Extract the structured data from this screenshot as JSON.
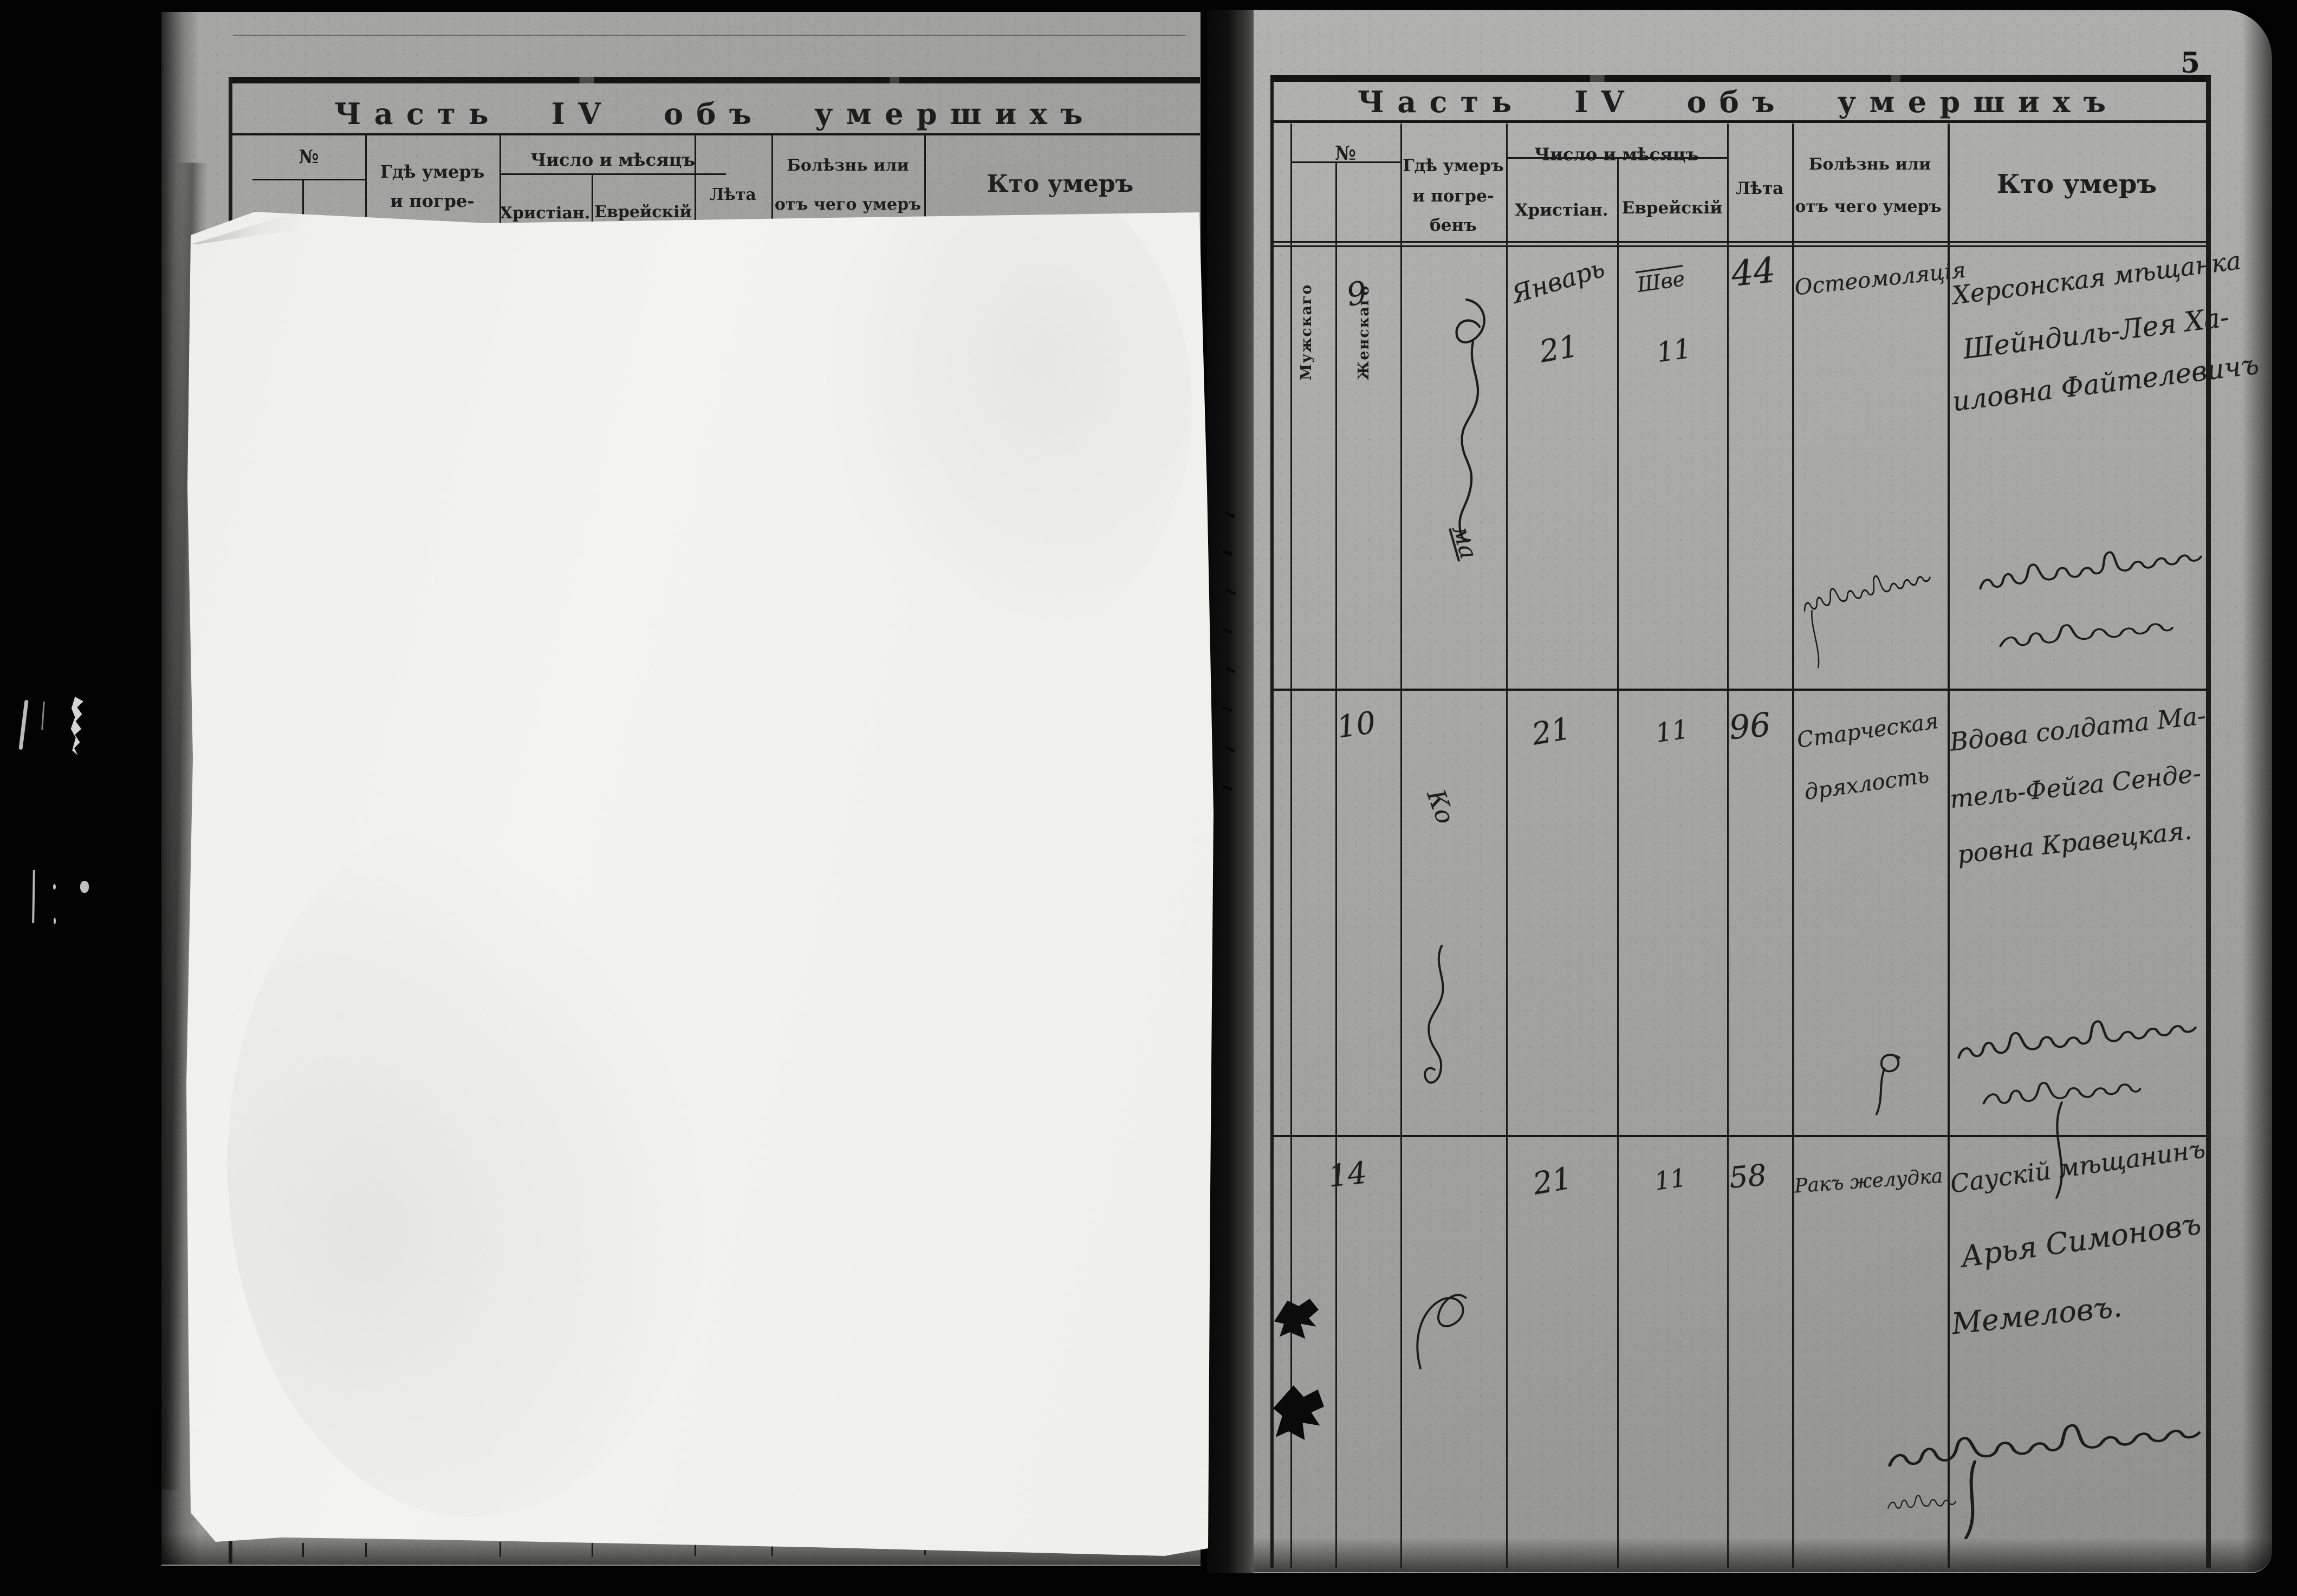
{
  "page_number": "5",
  "section_title": "Часть IV объ умершихъ",
  "headers": {
    "no": "№",
    "no_male": "Мужскаго",
    "no_female": "Женскаго",
    "where_line1": "Гдѣ умеръ",
    "where_line2": "и погре-",
    "where_line3": "бенъ",
    "date_group": "Число и мѣсяцъ",
    "date_christian": "Христіан.",
    "date_jewish": "Еврейскій",
    "age": "Лѣта",
    "cause_line1": "Болѣзнь или",
    "cause_line2": "отъ чего умеръ",
    "who": "Кто умеръ"
  },
  "entries": [
    {
      "number": "9",
      "place_script": "ма",
      "month_christian": "Январь",
      "day_christian": "21",
      "month_jewish": "Шве",
      "day_jewish": "11",
      "age": "44",
      "cause_line1": "Остеомоляція",
      "cause_line2": "",
      "who_line1": "Херсонская мѣщанка",
      "who_line2": "Шейндиль-Лея Ха-",
      "who_line3": "иловна Файтелевичъ"
    },
    {
      "number": "10",
      "place_script": "Ко",
      "month_christian": "",
      "day_christian": "21",
      "month_jewish": "",
      "day_jewish": "11",
      "age": "96",
      "cause_line1": "Старческая",
      "cause_line2": "дряхлость",
      "who_line1": "Вдова солдата Ма-",
      "who_line2": "тель-Фейга Сенде-",
      "who_line3": "ровна Кравецкая."
    },
    {
      "number": "14",
      "place_script": "",
      "month_christian": "",
      "day_christian": "21",
      "month_jewish": "",
      "day_jewish": "11",
      "age": "58",
      "cause_line1": "Ракъ желудка",
      "cause_line2": "",
      "who_line1": "Саускій мѣщанинъ",
      "who_line2": "Арья Симоновъ",
      "who_line3": "Мемеловъ."
    }
  ]
}
